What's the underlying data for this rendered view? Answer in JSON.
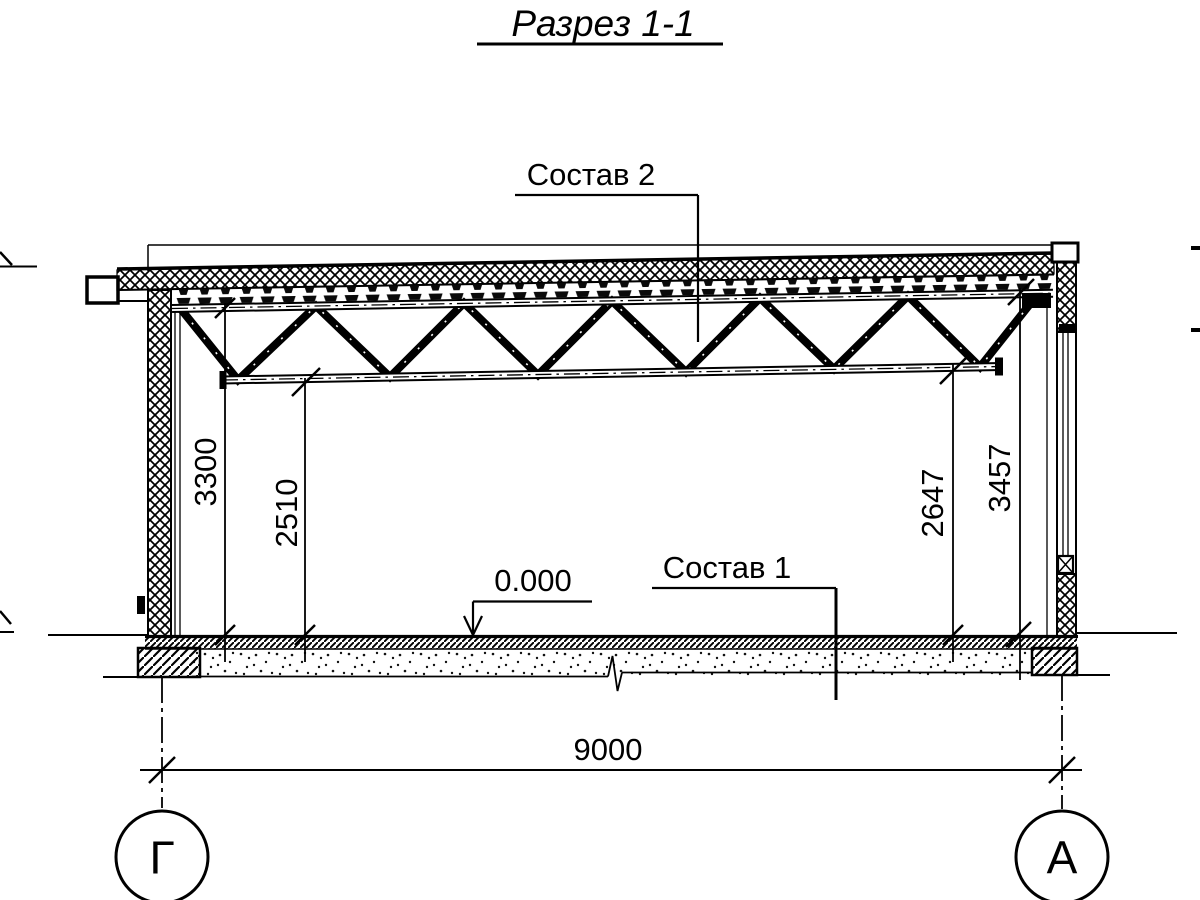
{
  "title": "Разрез 1-1",
  "callouts": {
    "roof_composition": "Состав 2",
    "floor_composition": "Состав 1",
    "floor_level": "0.000"
  },
  "dimensions": {
    "wall_left": "3300",
    "truss_left": "2510",
    "truss_right": "2647",
    "wall_right": "3457",
    "span": "9000"
  },
  "axes": {
    "left": "Г",
    "right": "А"
  },
  "colors": {
    "ink": "#000000",
    "paper": "#ffffff"
  }
}
